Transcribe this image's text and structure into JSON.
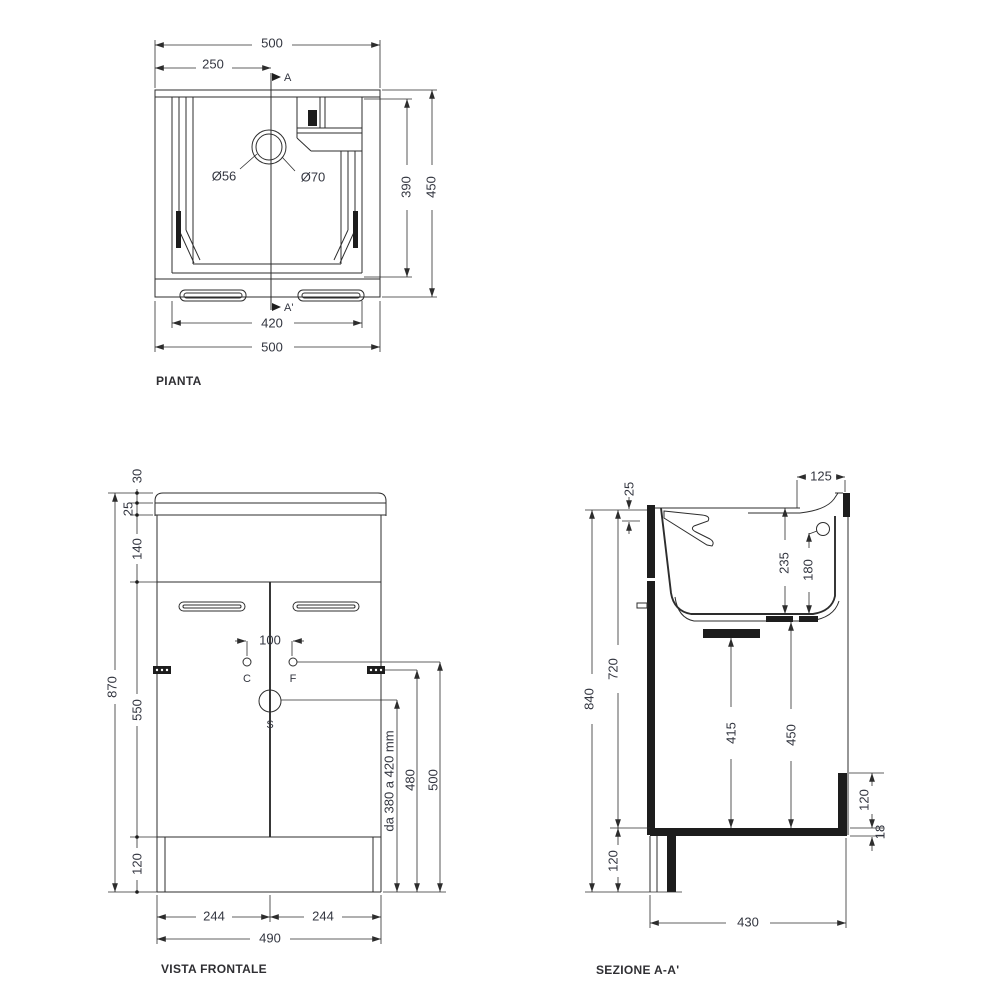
{
  "page": {
    "background": "#ffffff",
    "line_color": "#2d2d2d",
    "text_color": "#333640"
  },
  "plan": {
    "label": "PIANTA",
    "marker_top": "A",
    "marker_bottom": "A'",
    "dims": {
      "overall_width_top": "500",
      "center_offset": "250",
      "drain_inner_diameter": "Ø56",
      "drain_outer_diameter": "Ø70",
      "basin_depth": "390",
      "overall_depth": "450",
      "basin_width": "420",
      "overall_width_bottom": "500"
    }
  },
  "front": {
    "label": "VISTA FRONTALE",
    "markers": {
      "tap_c_label": "C",
      "tap_f_label": "F",
      "drain_label": "S"
    },
    "dims": {
      "rim_height": "30",
      "top_thickness": "25",
      "apron_height": "140",
      "overall_height": "870",
      "door_height": "550",
      "plinth_height": "120",
      "tap_spacing": "100",
      "drain_height_range": "da 380 a 420 mm",
      "side_height": "480",
      "tap_height": "500",
      "door_width_left": "244",
      "door_width_right": "244",
      "cabinet_width": "490"
    }
  },
  "section": {
    "label": "SEZIONE A-A'",
    "dims": {
      "top_thickness": "25",
      "tap_offset": "125",
      "basin_depth": "235",
      "tap_height": "180",
      "overall_height": "840",
      "interior_height": "720",
      "shelf_clearance": "415",
      "basin_clearance": "450",
      "plinth_height": "120",
      "rail_height": "120",
      "panel_thickness": "18",
      "base_depth": "430"
    }
  }
}
